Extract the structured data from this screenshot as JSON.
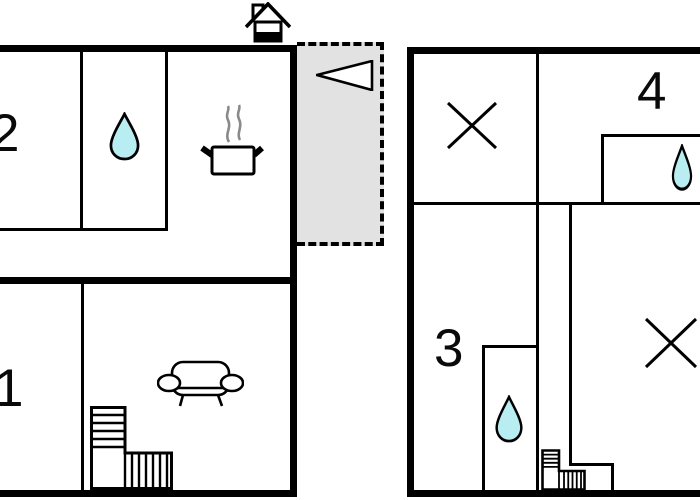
{
  "colors": {
    "background": "#ffffff",
    "wall": "#000000",
    "water_drop_fill": "#b8eef2",
    "terrace_fill": "#e2e2e2",
    "steam_gray": "#8a8a8a"
  },
  "icons": {
    "house": "house-with-chimney-icon",
    "direction_arrow": "left-pointing-triangle-icon",
    "water_drop": "water-drop-icon",
    "cooking_pot": "steaming-pot-icon",
    "sofa": "sofa-top-view-icon",
    "stairs": "l-shaped-stairs-icon",
    "cross": "diagonal-cross-icon"
  },
  "left_plan": {
    "rooms": [
      {
        "label": "2"
      },
      {
        "label": "1"
      }
    ]
  },
  "right_plan": {
    "rooms": [
      {
        "label": "3"
      },
      {
        "label": "4"
      }
    ]
  }
}
